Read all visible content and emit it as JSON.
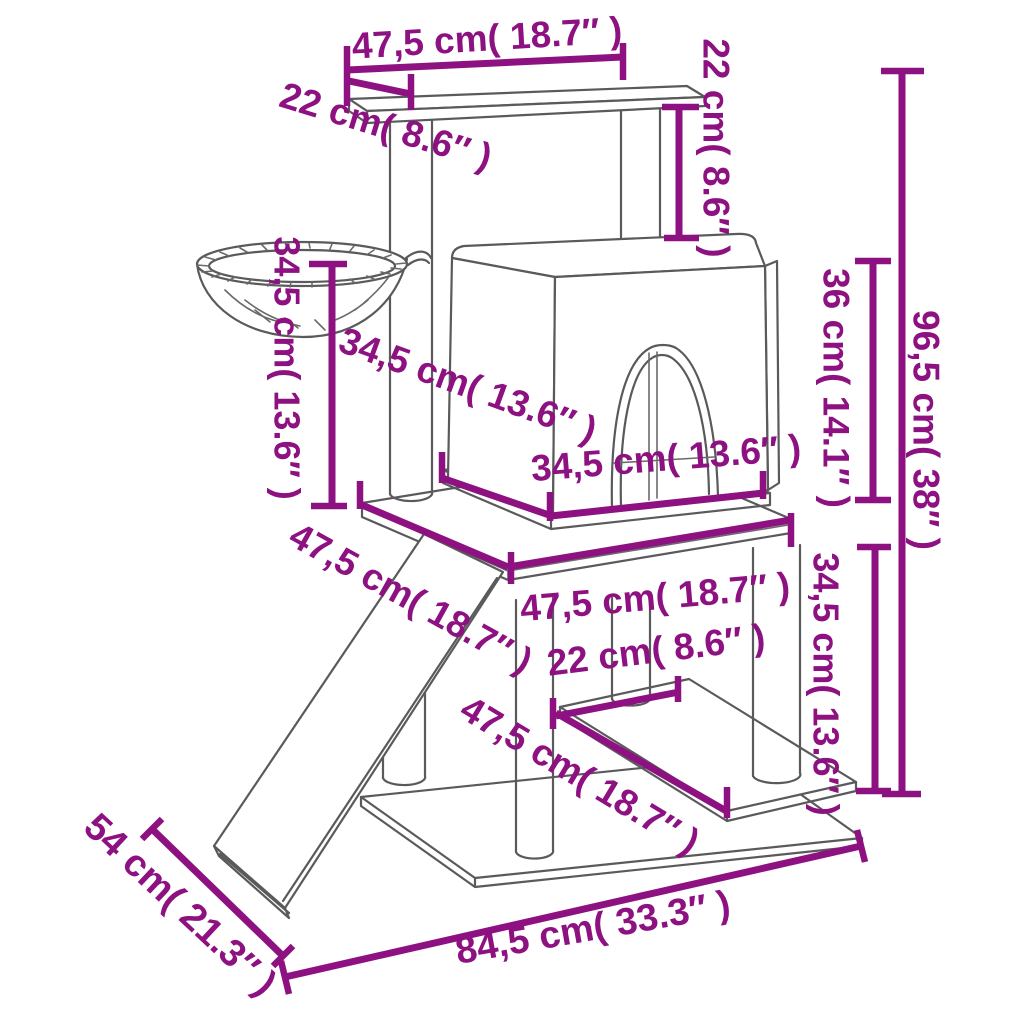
{
  "page": {
    "background": "#ffffff"
  },
  "colors": {
    "dimension": "#8D1181",
    "structure_line": "#5a5a5c"
  },
  "diagram": {
    "name": "cat-tree-dimension-diagram",
    "unit_primary": "cm",
    "unit_secondary": "inches",
    "dimensions": [
      {
        "id": "top-platform-width",
        "label": "47,5 cm( 18.7″ )"
      },
      {
        "id": "top-platform-depth",
        "label": "22 cm( 8.6″ )"
      },
      {
        "id": "top-gap-height",
        "label": "22 cm( 8.6″ )"
      },
      {
        "id": "basket-height",
        "label": "34,5 cm( 13.6″ )"
      },
      {
        "id": "house-depth",
        "label": "34,5 cm( 13.6″ )"
      },
      {
        "id": "house-width",
        "label": "34,5 cm( 13.6″ )"
      },
      {
        "id": "house-height",
        "label": "36 cm( 14.1″ )"
      },
      {
        "id": "total-height",
        "label": "96,5 cm( 38″ )"
      },
      {
        "id": "mid-platform-left",
        "label": "47,5 cm( 18.7″ )"
      },
      {
        "id": "mid-platform-front",
        "label": "47,5 cm( 18.7″ )"
      },
      {
        "id": "post-spacing",
        "label": "22 cm( 8.6″ )"
      },
      {
        "id": "lower-shelf-width",
        "label": "47,5 cm( 18.7″ )"
      },
      {
        "id": "lower-tier-height",
        "label": "34,5 cm( 13.6″ )"
      },
      {
        "id": "base-depth",
        "label": "54 cm( 21.3″ )"
      },
      {
        "id": "base-width",
        "label": "84,5 cm( 33.3″ )"
      }
    ]
  }
}
